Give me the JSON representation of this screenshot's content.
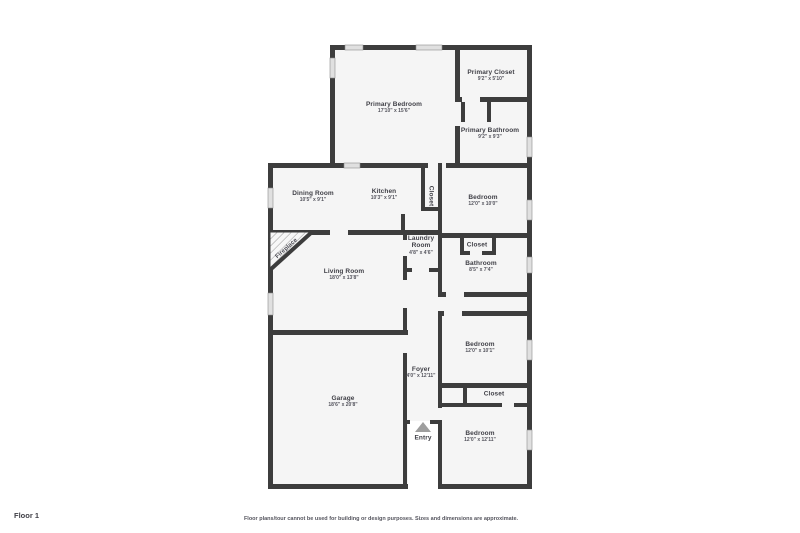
{
  "title": "Floor plan - Floor 1",
  "colors": {
    "wall": "#3d3d3d",
    "room_fill": "#f5f5f5",
    "window_fill": "#e0e0e0",
    "label_text": "#3f3f46",
    "entry_marker": "#9e9e9e",
    "background": "#ffffff"
  },
  "rooms": [
    {
      "name": "Primary Bedroom",
      "dims": "17'10\" x 15'6\""
    },
    {
      "name": "Primary Closet",
      "dims": "9'2\" x 5'10\""
    },
    {
      "name": "Primary Bathroom",
      "dims": "9'2\" x 9'3\""
    },
    {
      "name": "Dining Room",
      "dims": "10'5\" x 9'1\""
    },
    {
      "name": "Kitchen",
      "dims": "10'3\" x 9'1\""
    },
    {
      "name": "Closet",
      "dims": ""
    },
    {
      "name": "Bedroom",
      "dims": "12'0\" x 10'0\""
    },
    {
      "name": "Laundry Room",
      "dims": "4'8\" x 4'6\""
    },
    {
      "name": "Closet",
      "dims": ""
    },
    {
      "name": "Bathroom",
      "dims": "8'5\" x 7'4\""
    },
    {
      "name": "Living Room",
      "dims": "18'0\" x 13'8\""
    },
    {
      "name": "Fireplace",
      "dims": ""
    },
    {
      "name": "Bedroom",
      "dims": "12'0\" x 10'1\""
    },
    {
      "name": "Foyer",
      "dims": "4'0\" x 12'11\""
    },
    {
      "name": "Garage",
      "dims": "18'6\" x 20'8\""
    },
    {
      "name": "Closet",
      "dims": ""
    },
    {
      "name": "Entry",
      "dims": ""
    },
    {
      "name": "Bedroom",
      "dims": "12'0\" x 12'11\""
    }
  ],
  "footer": {
    "floor_label": "Floor 1",
    "disclaimer": "Floor plans/tour cannot be used for building or design purposes. Sizes and dimensions are approximate."
  }
}
